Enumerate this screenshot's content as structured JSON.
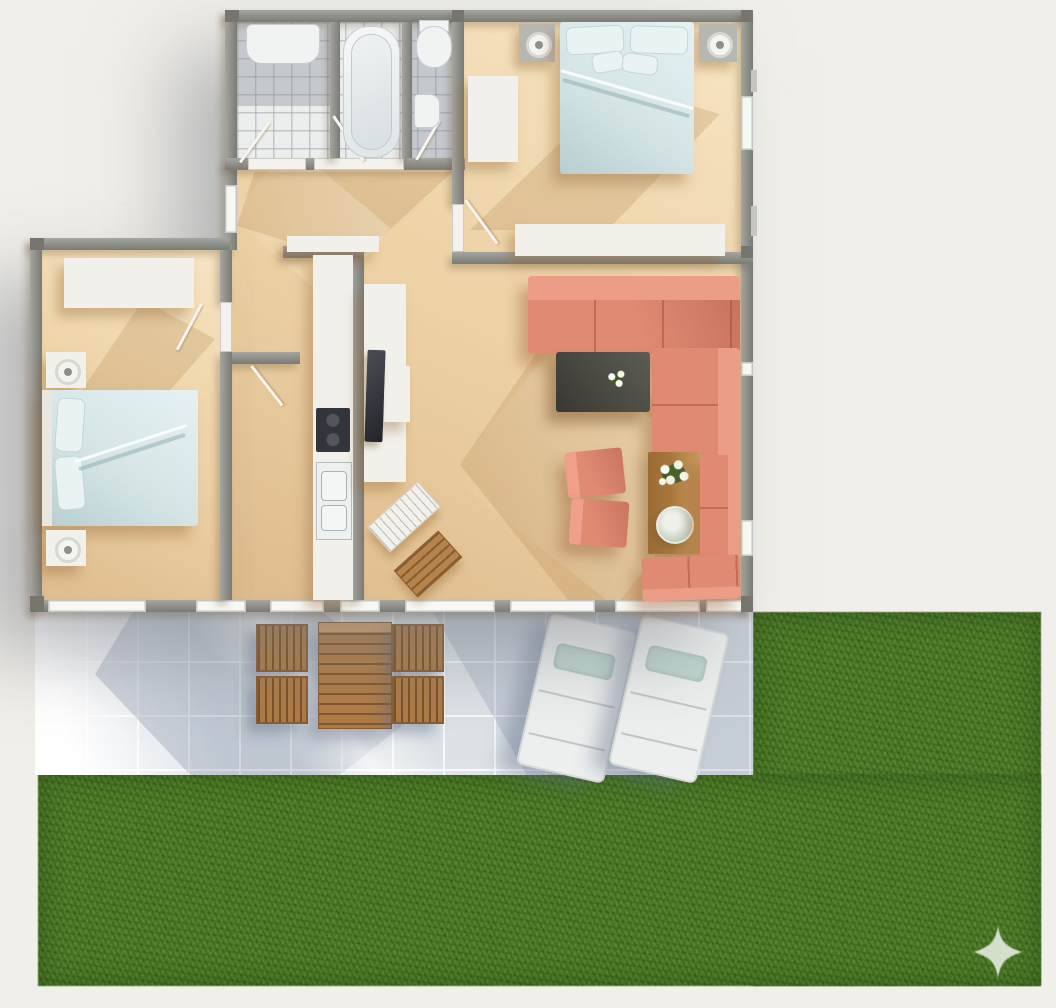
{
  "meta": {
    "type": "floor-plan-render",
    "view": "top-down",
    "description": "Sunlit 3D top-down rendering of a two-bedroom apartment with tiled patio and grass lawn"
  },
  "palette": {
    "background": "#f1efe9",
    "wall": "#8f8f89",
    "wall_dark": "#76766f",
    "window": "#f7f7f3",
    "floor": "#eed3a7",
    "tile_bath": "#eceeee",
    "patio": "#dde3e7",
    "grass": "#4c7a28",
    "sofa_coral": "#e08a74",
    "wood_garden": "#b07c46",
    "wood_dining": "#ab7a3e",
    "coffee_table": "#4b4a41",
    "bedding": "#d5e5e6",
    "furniture_white": "#f1f0ea",
    "nightstand_gray": "#b7b7b1",
    "tv_dark": "#33353c",
    "lounger": "#eef0ef",
    "lounger_pillow": "#c2d8d2",
    "sparkle": "#e2e8da"
  },
  "rooms": [
    {
      "name": "bathroom",
      "fixtures": [
        "vanity sink",
        "bathtub",
        "shower door"
      ]
    },
    {
      "name": "wc",
      "fixtures": [
        "toilet",
        "hand basin"
      ]
    },
    {
      "name": "bedroom-main",
      "furniture": [
        "double bed with light blue bedding",
        "2 nightstands with lamps",
        "wardrobe",
        "side cabinet"
      ]
    },
    {
      "name": "bedroom-second",
      "furniture": [
        "double bed with light blue bedding",
        "2 nightstands with lamps",
        "wardrobe"
      ]
    },
    {
      "name": "hallway",
      "features": [
        "open door leaves",
        "front door"
      ]
    },
    {
      "name": "kitchen",
      "furniture": [
        "counter run",
        "black cooktop",
        "double sink"
      ]
    },
    {
      "name": "media-nook",
      "furniture": [
        "white sideboard",
        "flat tv",
        "keyboard desk",
        "wooden stool"
      ]
    },
    {
      "name": "living-dining",
      "furniture": [
        "coral corner sofa",
        "dark coffee table with white flowers",
        "wooden dining table",
        "flower bouquet",
        "round serving plate",
        "2 coral chairs",
        "coral corner bench"
      ]
    },
    {
      "name": "patio",
      "furniture": [
        "wooden garden table",
        "4 wooden garden chairs",
        "2 white sun loungers with teal cushions"
      ]
    },
    {
      "name": "lawn",
      "features": [
        "L-shaped grass field",
        "four-point sparkle watermark"
      ]
    }
  ],
  "watermark": {
    "icon": "four-point-star-sparkle"
  }
}
